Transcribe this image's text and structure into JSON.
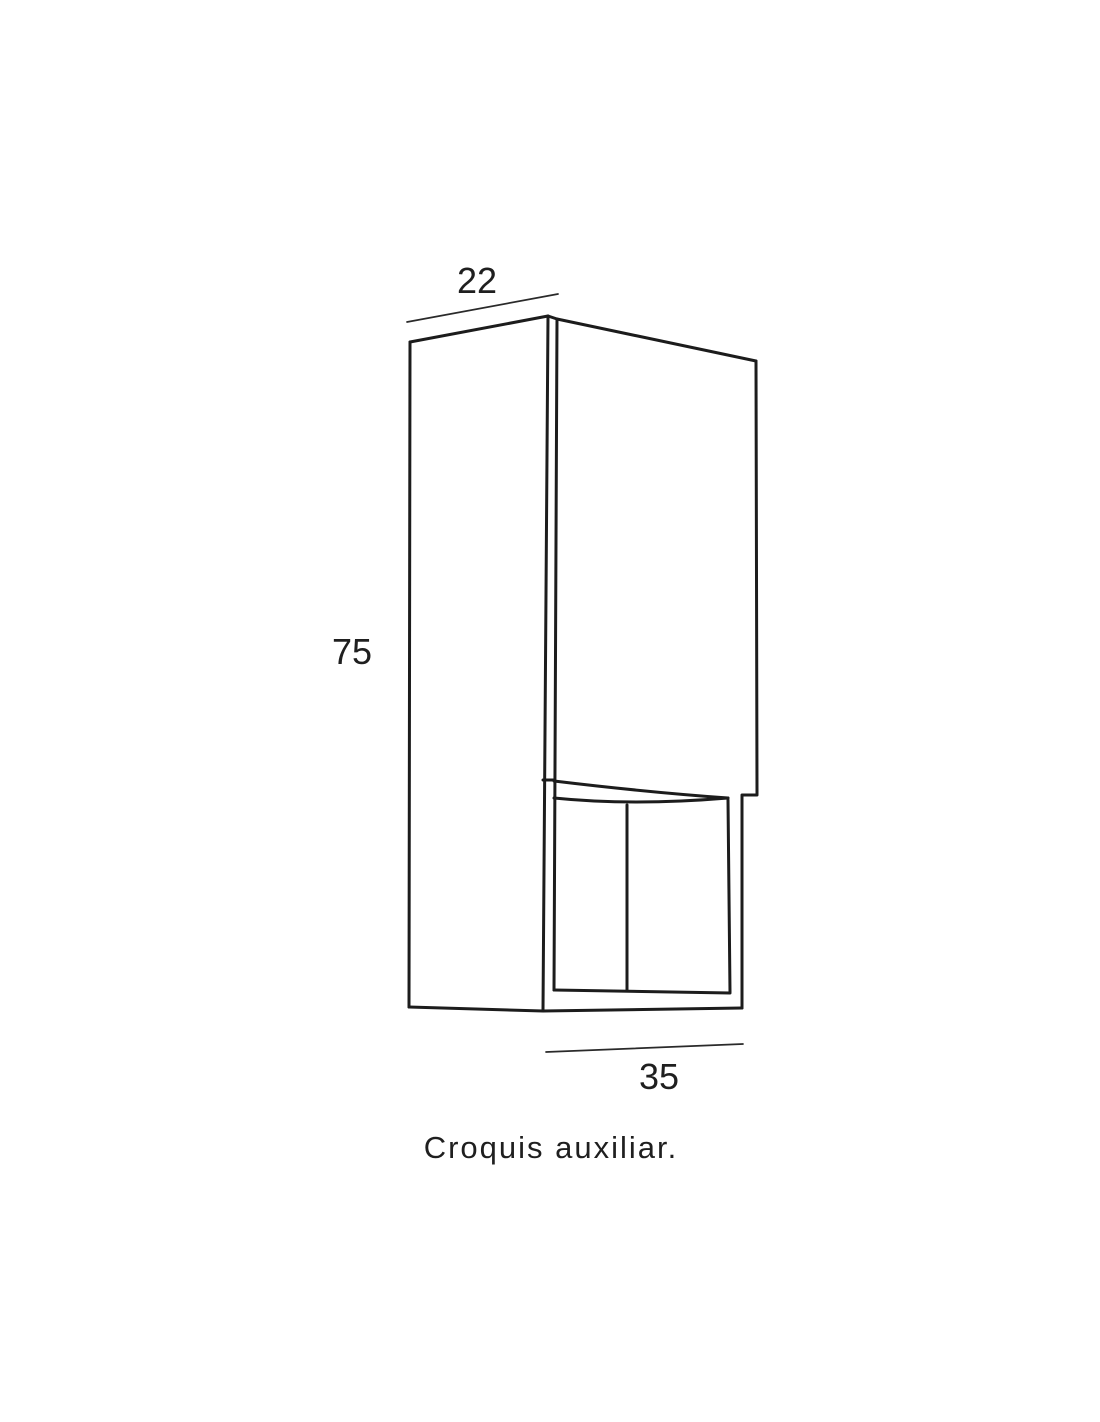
{
  "page": {
    "background_color": "#ffffff",
    "line_color": "#1c1c1c",
    "text_color": "#1f1f1f"
  },
  "diagram": {
    "type": "furniture-technical-sketch",
    "caption": "Croquis auxiliar.",
    "dimensions": {
      "top_depth": "22",
      "left_height": "75",
      "bottom_width": "35"
    }
  }
}
